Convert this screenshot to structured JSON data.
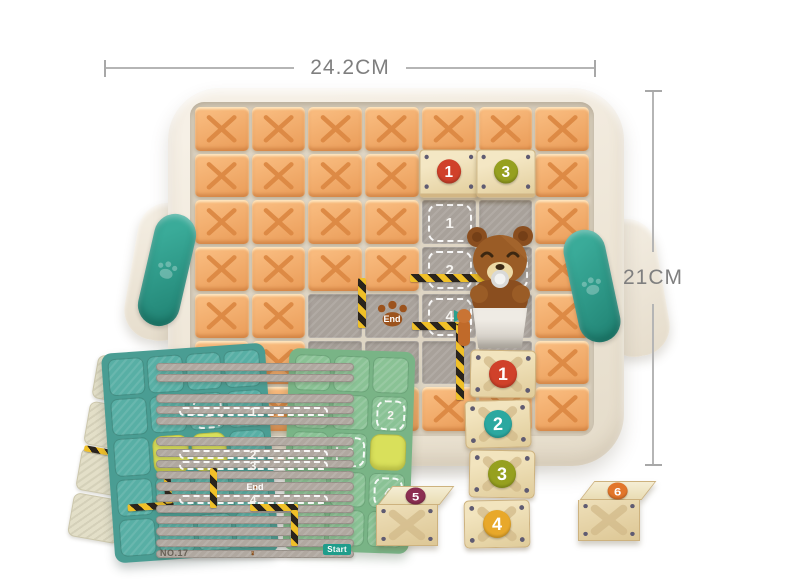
{
  "dimensions": {
    "width_label": "24.2CM",
    "height_label": "21CM"
  },
  "board": {
    "end_label": "End",
    "grid": [
      [
        "O",
        "O",
        "O",
        "O",
        "O",
        "O",
        "O"
      ],
      [
        "O",
        "O",
        "O",
        "O",
        "W:1",
        "W:3",
        "O"
      ],
      [
        "O",
        "O",
        "O",
        "O",
        "T:1",
        "G",
        "O"
      ],
      [
        "O",
        "O",
        "O",
        "O",
        "T:2",
        "T:",
        "O"
      ],
      [
        "O",
        "O",
        "G",
        "E",
        "T:4",
        "G",
        "O"
      ],
      [
        "O",
        "O",
        "G",
        "G",
        "G",
        "G",
        "O"
      ],
      [
        "O",
        "O",
        "O",
        "O",
        "O",
        "O",
        "O"
      ]
    ]
  },
  "stack": {
    "blocks": [
      {
        "label": "1"
      },
      {
        "label": "2"
      },
      {
        "label": "3"
      },
      {
        "label": "4"
      }
    ]
  },
  "loose_blocks": [
    {
      "label": "5"
    },
    {
      "label": "6"
    }
  ],
  "cards": {
    "khaki": {
      "grid": [
        [
          "C",
          "C"
        ],
        [
          "C",
          "."
        ],
        [
          "C",
          "C"
        ],
        [
          "C",
          "C"
        ]
      ]
    },
    "teal": {
      "grid": [
        [
          "C",
          "C",
          "C",
          "C"
        ],
        [
          "C",
          "C",
          "T:1",
          "C"
        ],
        [
          "C",
          "Y",
          "Y",
          "C"
        ],
        [
          "C",
          "C",
          "C",
          "C"
        ],
        [
          "C",
          "C",
          "C",
          "C"
        ]
      ]
    },
    "front": {
      "label": "NO.17",
      "start_label": "Start",
      "end_label": "End",
      "grid": [
        [
          ".",
          ".",
          "C",
          "C"
        ],
        [
          ".",
          "C",
          "T:1",
          "C"
        ],
        [
          ".",
          "C",
          "T:2",
          "T:3"
        ],
        [
          "C",
          "E",
          "T:4",
          "C"
        ],
        [
          "C",
          "C",
          "C",
          "S"
        ]
      ]
    },
    "green": {
      "label": "NO.",
      "grid": [
        [
          "C",
          "C",
          "C"
        ],
        [
          "C",
          "C",
          "T:2"
        ],
        [
          "C",
          "T:3",
          "Y"
        ],
        [
          "C",
          "C",
          "T:4"
        ],
        [
          "C",
          "C",
          "C"
        ]
      ]
    }
  },
  "colors": {
    "numbers": {
      "1": "#d0412a",
      "2": "#2ba8a0",
      "3": "#96a01f",
      "4": "#e8a82a",
      "5": "#8c2f52",
      "6": "#e2762a"
    },
    "accent_teal": "#2e9e8f",
    "block_orange": "#f2a868",
    "tray_cream": "#f1eadd"
  }
}
